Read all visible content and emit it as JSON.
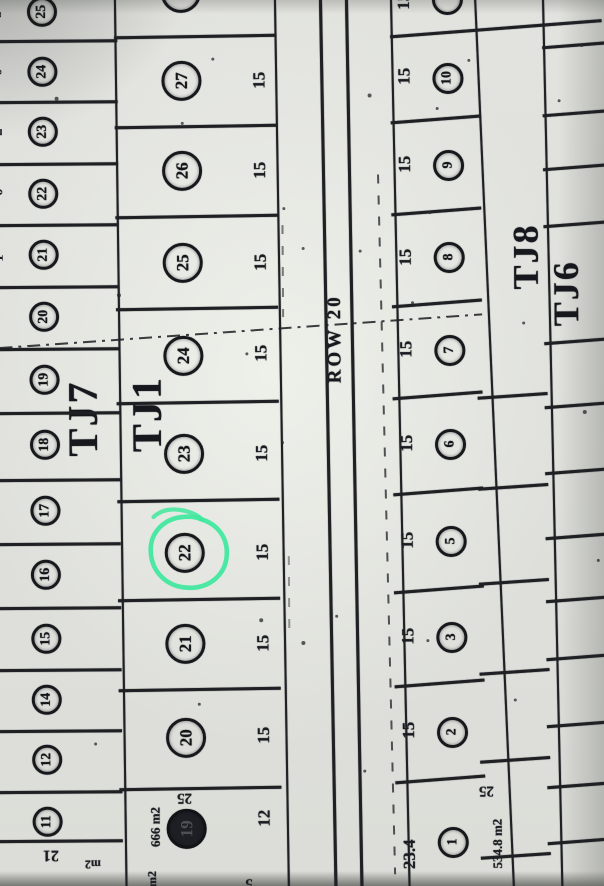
{
  "annotation": {
    "highlight_color": "#3ee89d",
    "highlighted_lot": "22"
  },
  "road": {
    "label": "ROW 20"
  },
  "blocks": {
    "left": {
      "label": "TJ7",
      "lot_numbers": [
        "25",
        "24",
        "23",
        "22",
        "21",
        "20",
        "19",
        "18",
        "17",
        "16",
        "15",
        "14",
        "12",
        "11"
      ],
      "edge_fragments": [
        "5",
        "0",
        "2",
        "0",
        "1"
      ]
    },
    "tj1": {
      "label": "TJ1",
      "lots": [
        {
          "num": "",
          "dim": ""
        },
        {
          "num": "27",
          "dim": "15"
        },
        {
          "num": "26",
          "dim": "15"
        },
        {
          "num": "25",
          "dim": "15"
        },
        {
          "num": "24",
          "dim": "15"
        },
        {
          "num": "23",
          "dim": "15"
        },
        {
          "num": "22",
          "dim": "15"
        },
        {
          "num": "21",
          "dim": "15"
        },
        {
          "num": "20",
          "dim": "15"
        },
        {
          "num": "19",
          "dim": "12",
          "area": "666 m2",
          "side_width": "25"
        }
      ]
    },
    "tj8": {
      "label": "TJ8",
      "lots": [
        {
          "num": "",
          "dim": "15"
        },
        {
          "num": "10",
          "dim": "15"
        },
        {
          "num": "9",
          "dim": "15"
        },
        {
          "num": "8",
          "dim": "15"
        },
        {
          "num": "7",
          "dim": "15"
        },
        {
          "num": "6",
          "dim": "15"
        },
        {
          "num": "5",
          "dim": "15"
        },
        {
          "num": "3",
          "dim": "15"
        },
        {
          "num": "2",
          "dim": "15"
        },
        {
          "num": "1",
          "dim": "23.4",
          "area": "534.8 m2",
          "side_width": "25"
        }
      ]
    },
    "tj6": {
      "label": "TJ6"
    }
  },
  "fragments": {
    "bottom_left_width": "21",
    "bottom_left_unit": "m2",
    "bottom_mid_unit": "m2",
    "bottom_mid_digit": "5"
  }
}
